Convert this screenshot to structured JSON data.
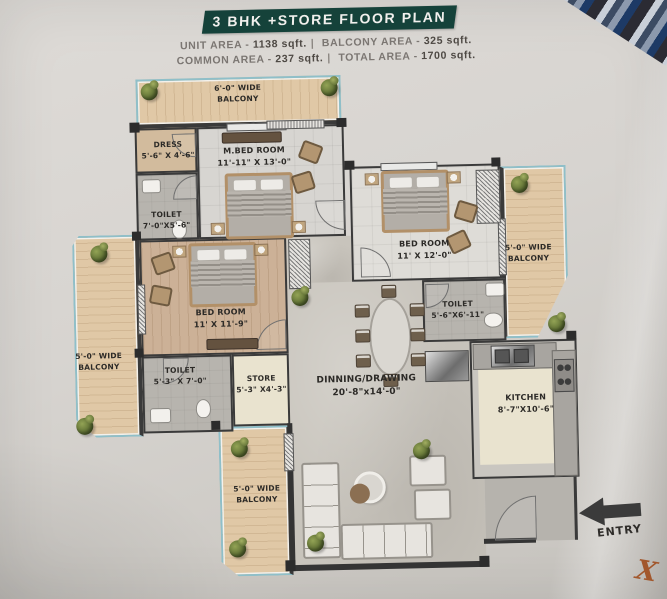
{
  "header": {
    "title": "3 BHK +STORE FLOOR PLAN",
    "area_line1": {
      "label1": "UNIT AREA - ",
      "value1": "1138 sqft.",
      "sep": "|",
      "label2": " BALCONY AREA - ",
      "value2": "325 sqft."
    },
    "area_line2": {
      "label1": "COMMON AREA - ",
      "value1": "237 sqft.",
      "sep": "|",
      "label2": " TOTAL AREA - ",
      "value2": "1700 sqft."
    }
  },
  "plan": {
    "rooms": {
      "balcony_top": {
        "line1": "6'-0\" WIDE",
        "line2": "BALCONY"
      },
      "dress": {
        "line1": "DRESS",
        "line2": "5'-6\" X 4'-6\""
      },
      "m_bedroom": {
        "line1": "M.BED ROOM",
        "line2": "11'-11\" X 13'-0\""
      },
      "toilet_m": {
        "line1": "TOILET",
        "line2": "7'-0\"X5'-6\""
      },
      "bedroom_right": {
        "line1": "BED ROOM",
        "line2": "11' X 12'-0\""
      },
      "balcony_right": {
        "line1": "5'-0\" WIDE",
        "line2": "BALCONY"
      },
      "toilet_right": {
        "line1": "TOILET",
        "line2": "5'-6\"X6'-11\""
      },
      "bedroom_left": {
        "line1": "BED ROOM",
        "line2": "11' X 11'-9\""
      },
      "balcony_left": {
        "line1": "5'-0\" WIDE",
        "line2": "BALCONY"
      },
      "toilet_left": {
        "line1": "TOILET",
        "line2": "5'-3\" X 7'-0\""
      },
      "store": {
        "line1": "STORE",
        "line2": "5'-3\" X4'-3\""
      },
      "dining": {
        "line1": "DINNING/DRAWING",
        "line2": "20'-8\"x14'-0\""
      },
      "kitchen": {
        "line1": "KITCHEN",
        "line2": "8'-7\"X10'-6\""
      },
      "balcony_bottom": {
        "line1": "5'-0\" WIDE",
        "line2": "BALCONY"
      }
    },
    "entry_label": "ENTRY",
    "watermark": "X"
  },
  "palette": {
    "banner_teal": "#15423a",
    "wall": "#3a3a3a",
    "glass_railing": "#8fbfc9",
    "balcony_wood": "#e0c8a6",
    "paper": "#d7d4d0",
    "watermark_color": "#a2572c"
  }
}
